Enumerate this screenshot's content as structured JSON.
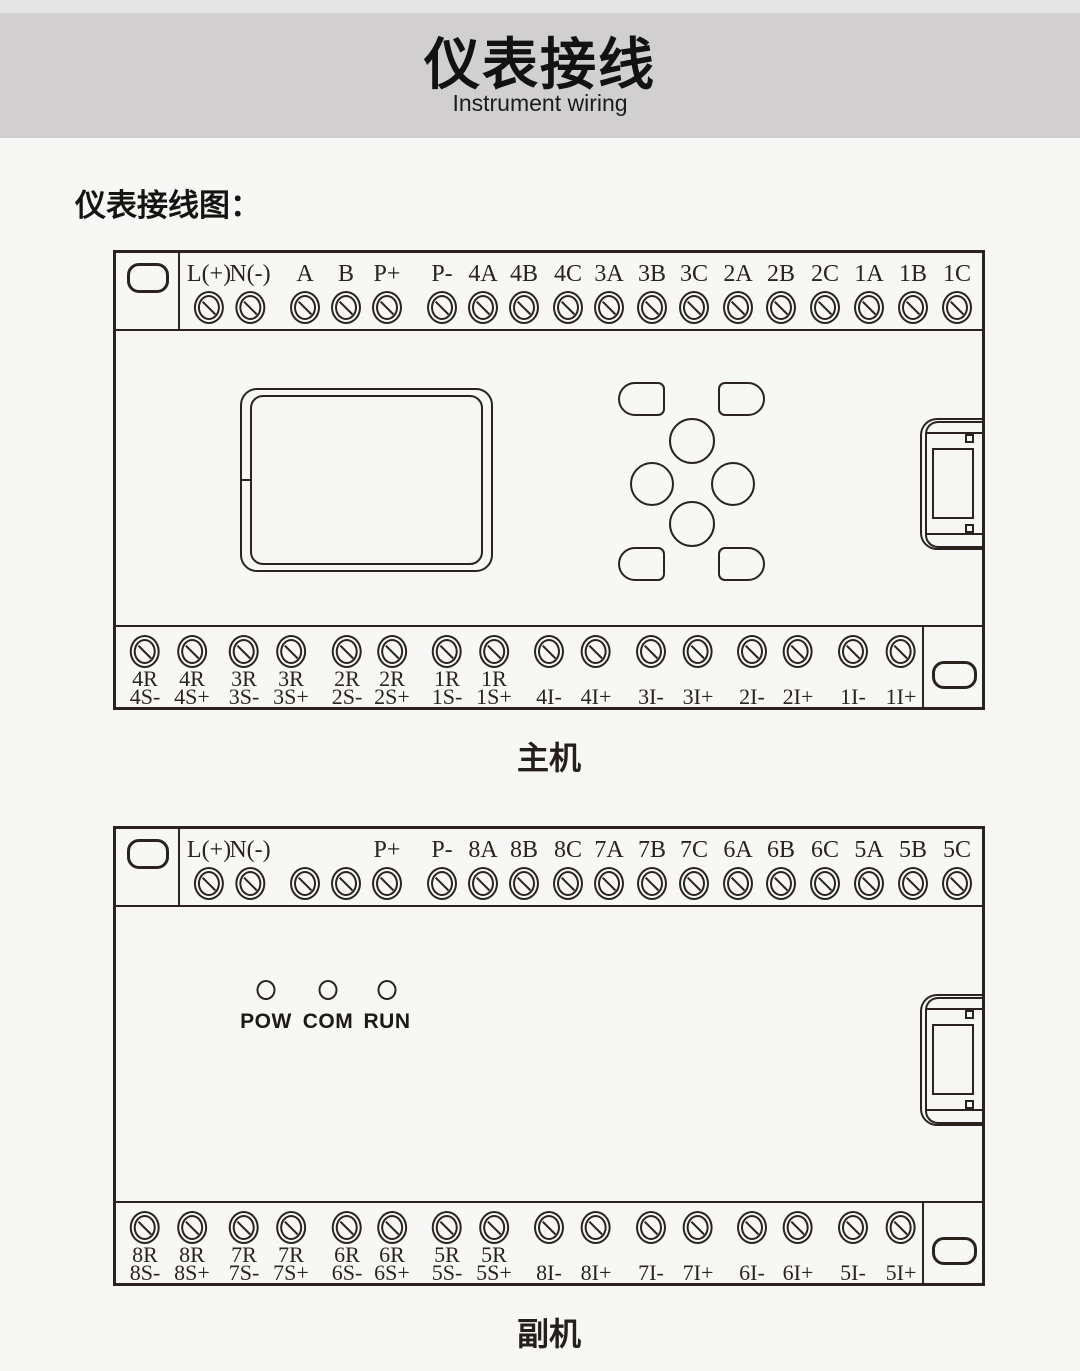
{
  "theme": {
    "page_bg": "#f7f7f6",
    "top_strip_bg": "#e6e5e6",
    "header_bg": "#d1cfd0",
    "line_color": "#2a231e"
  },
  "header": {
    "title": "仪表接线",
    "subtitle": "Instrument wiring"
  },
  "section_heading": "仪表接线图：",
  "main_unit": {
    "caption": "主机",
    "top_labels": [
      "L(+)",
      "N(-)",
      "A",
      "B",
      "P+",
      "P-",
      "4A",
      "4B",
      "4C",
      "3A",
      "3B",
      "3C",
      "2A",
      "2B",
      "2C",
      "1A",
      "1B",
      "1C"
    ],
    "bottom_labels": [
      [
        "4R",
        "4S-"
      ],
      [
        "4R",
        "4S+"
      ],
      [
        "3R",
        "3S-"
      ],
      [
        "3R",
        "3S+"
      ],
      [
        "2R",
        "2S-"
      ],
      [
        "2R",
        "2S+"
      ],
      [
        "1R",
        "1S-"
      ],
      [
        "1R",
        "1S+"
      ],
      [
        "4I-"
      ],
      [
        "4I+"
      ],
      [
        "3I-"
      ],
      [
        "3I+"
      ],
      [
        "2I-"
      ],
      [
        "2I+"
      ],
      [
        "1I-"
      ],
      [
        "1I+"
      ]
    ]
  },
  "sub_unit": {
    "caption": "副机",
    "top_labels": [
      "L(+)",
      "N(-)",
      "",
      "",
      "P+",
      "P-",
      "8A",
      "8B",
      "8C",
      "7A",
      "7B",
      "7C",
      "6A",
      "6B",
      "6C",
      "5A",
      "5B",
      "5C"
    ],
    "bottom_labels": [
      [
        "8R",
        "8S-"
      ],
      [
        "8R",
        "8S+"
      ],
      [
        "7R",
        "7S-"
      ],
      [
        "7R",
        "7S+"
      ],
      [
        "6R",
        "6S-"
      ],
      [
        "6R",
        "6S+"
      ],
      [
        "5R",
        "5S-"
      ],
      [
        "5R",
        "5S+"
      ],
      [
        "8I-"
      ],
      [
        "8I+"
      ],
      [
        "7I-"
      ],
      [
        "7I+"
      ],
      [
        "6I-"
      ],
      [
        "6I+"
      ],
      [
        "5I-"
      ],
      [
        "5I+"
      ]
    ],
    "leds": [
      "POW",
      "COM",
      "RUN"
    ]
  }
}
